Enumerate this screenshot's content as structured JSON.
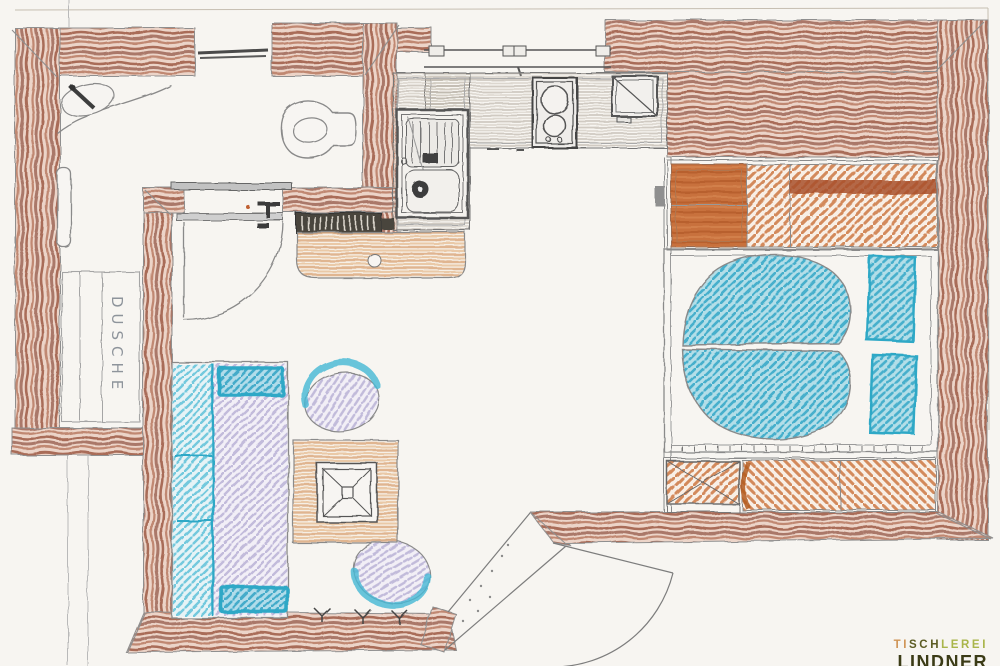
{
  "drawing": {
    "description": "Hand-drawn apartment floor plan, colored pencil on white paper"
  },
  "labels": {
    "shower": "DUSCHE"
  },
  "logo": {
    "line1": [
      {
        "text": "TI"
      },
      {
        "text": "SCH"
      },
      {
        "text": "LEREI"
      }
    ],
    "line2": "LINDNER"
  },
  "colors": {
    "paper": "#f7f5f1",
    "wall_brown": "#a2614b",
    "wall_brown_dark": "#8f5240",
    "wardrobe_orange": "#c8713e",
    "accent_orange_dark": "#a8502a",
    "bed_turquoise": "#2fa8c6",
    "sofa_lavender": "#b7aed4",
    "rug_tan": "#dba87a",
    "counter_gray": "#b5aea3",
    "pencil_gray": "#8a8a8a",
    "radiator_dark": "#4a443c",
    "logo_tan": "#cf9455",
    "logo_olive": "#5c5c24",
    "logo_green": "#a9b54a",
    "logo_dark": "#3b3b16"
  },
  "plan": {
    "rooms": [
      {
        "name": "bathroom",
        "furniture": [
          "vanity-sink",
          "toilet",
          "wall-cabinet",
          "shower",
          "window",
          "sliding-door"
        ]
      },
      {
        "name": "kitchen",
        "furniture": [
          "l-shaped-counter",
          "kitchen-sink",
          "two-burner-cooktop",
          "appliance",
          "window"
        ]
      },
      {
        "name": "living-room",
        "furniture": [
          "radiator",
          "bench-counter",
          "sofa",
          "two-armchairs",
          "square-table",
          "rug",
          "plants"
        ]
      },
      {
        "name": "bedroom",
        "furniture": [
          "wardrobe",
          "heart-shaped-bed",
          "two-nightstand-cushions",
          "sideboard",
          "crossed-box"
        ]
      },
      {
        "name": "entrance",
        "furniture": [
          "diagonal-threshold",
          "door-swing"
        ]
      }
    ]
  }
}
